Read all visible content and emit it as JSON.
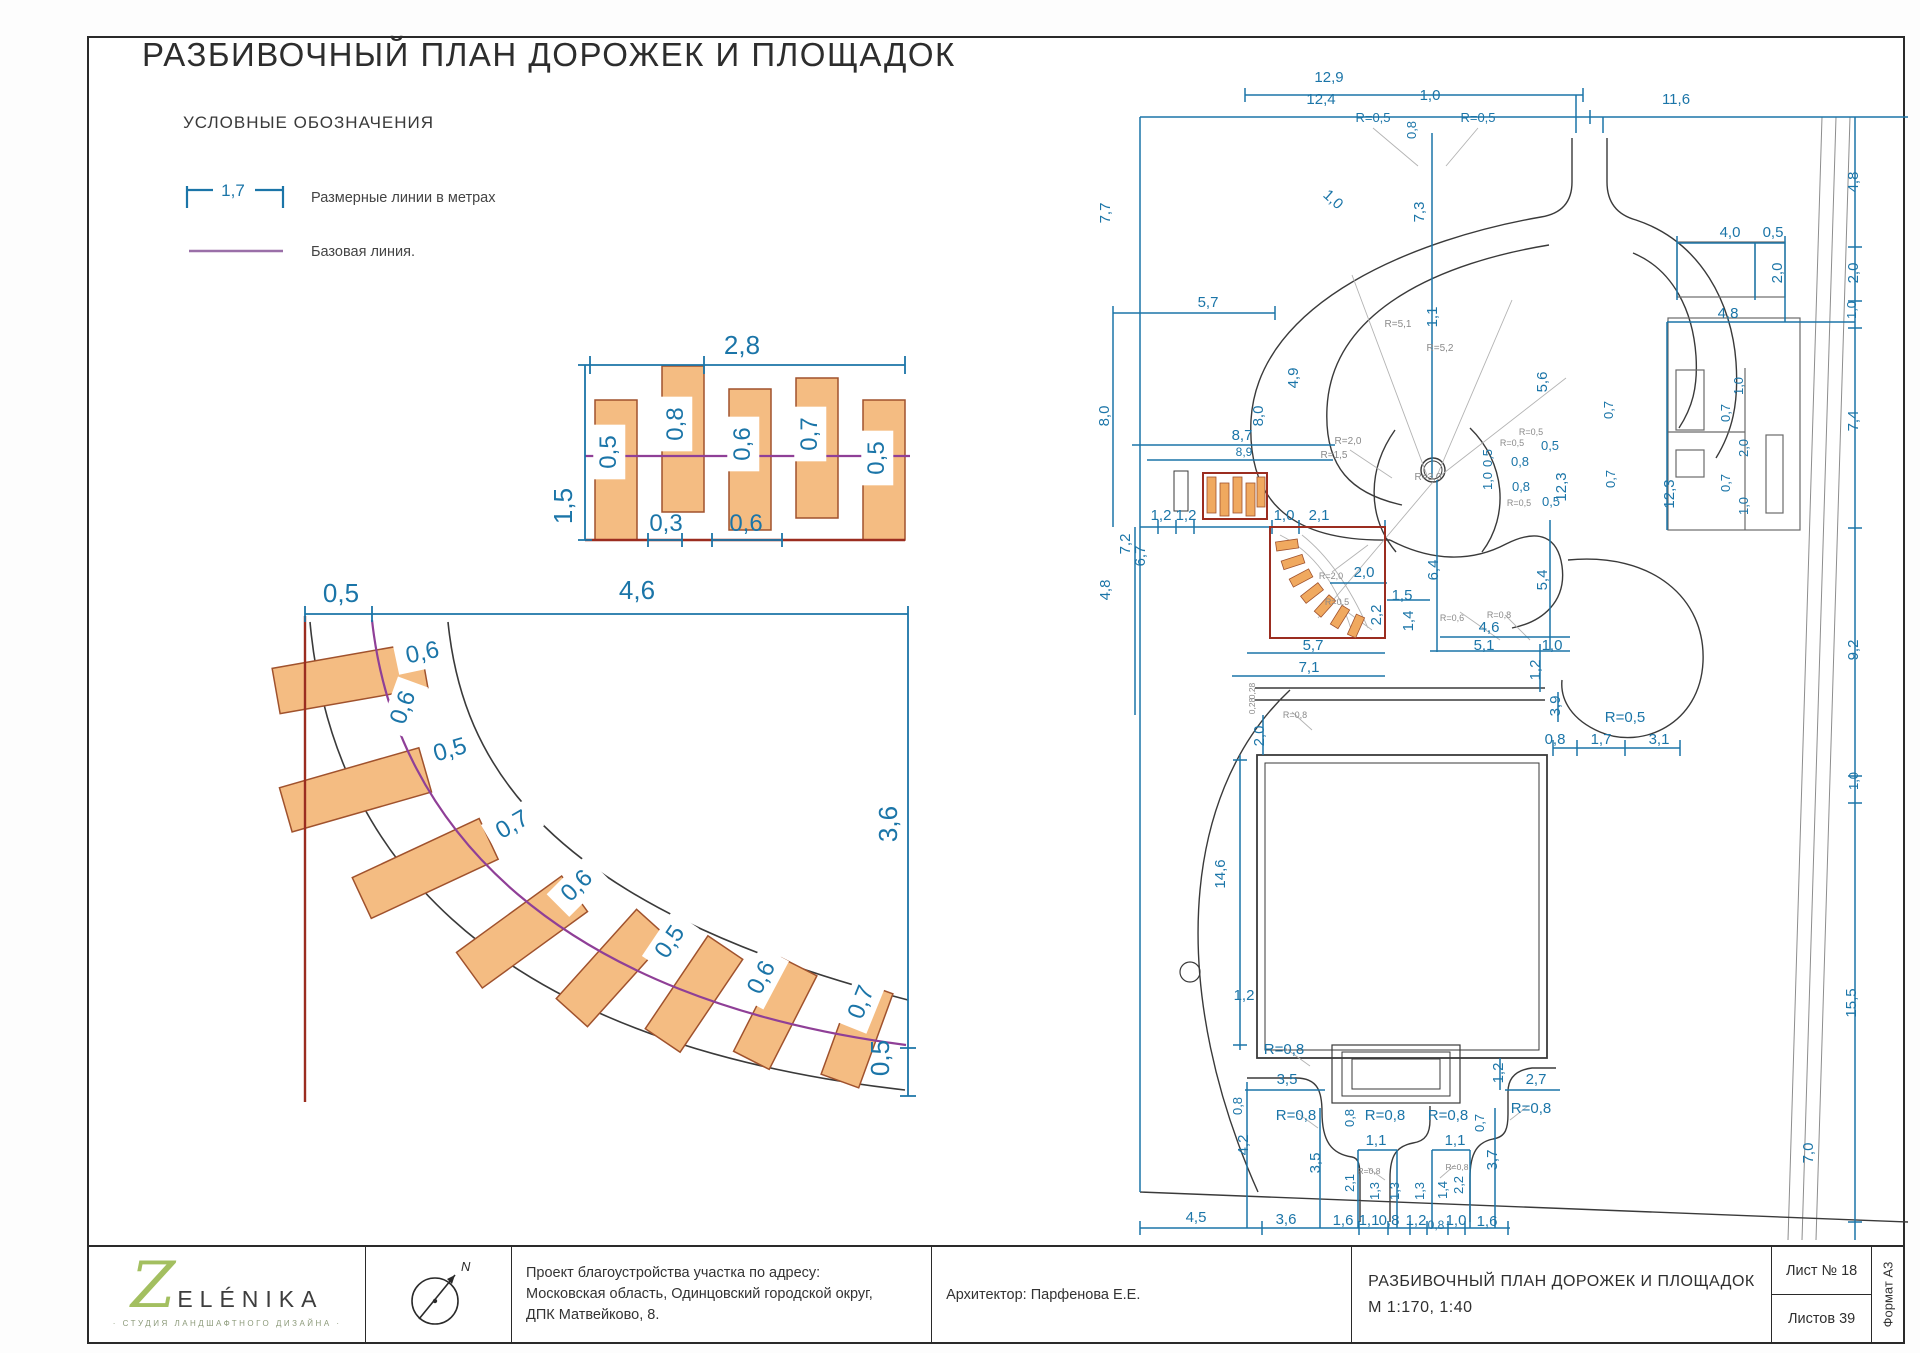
{
  "sheet": {
    "title": "РАЗБИВОЧНЫЙ ПЛАН ДОРОЖЕК И ПЛОЩАДОК"
  },
  "colors": {
    "dim": "#1b75a8",
    "geometry": "#3a3a3a",
    "red": "#9b2d20",
    "stone_fill": "#f4bc82",
    "stone_edge": "#a0522d",
    "baseline": "#8f3f97",
    "leader": "#a8a8a8"
  },
  "legend": {
    "heading": "УСЛОВНЫЕ ОБОЗНАЧЕНИЯ",
    "dim_example": "1,7",
    "dim_label": "Размерные линии в метрах",
    "base_label": "Базовая линия."
  },
  "detail_row": {
    "stones": [
      {
        "t": "0,5",
        "x": 616,
        "y": 452,
        "r": -90,
        "s": 24,
        "b": true
      },
      {
        "t": "0,8",
        "x": 683,
        "y": 424,
        "r": -90,
        "s": 24,
        "b": true
      },
      {
        "t": "0,6",
        "x": 750,
        "y": 444,
        "r": -90,
        "s": 24,
        "b": true
      },
      {
        "t": "0,7",
        "x": 817,
        "y": 434,
        "r": -90,
        "s": 24,
        "b": true
      },
      {
        "t": "0,5",
        "x": 884,
        "y": 458,
        "r": -90,
        "s": 24,
        "b": true
      }
    ],
    "labels": [
      {
        "t": "2,8",
        "x": 742,
        "y": 354,
        "s": 26
      },
      {
        "t": "1,5",
        "x": 572,
        "y": 506,
        "r": -90,
        "s": 26
      },
      {
        "t": "0,3",
        "x": 666,
        "y": 531,
        "s": 24
      },
      {
        "t": "0,6",
        "x": 746,
        "y": 531,
        "s": 24
      }
    ]
  },
  "detail_curve": {
    "stones": [
      {
        "t": "0,6",
        "x": 424,
        "y": 660,
        "r": -12,
        "s": 24,
        "b": true
      },
      {
        "t": "0,6",
        "x": 410,
        "y": 710,
        "r": -70,
        "s": 24,
        "b": true
      },
      {
        "t": "0,5",
        "x": 452,
        "y": 757,
        "r": -16,
        "s": 24,
        "b": true
      },
      {
        "t": "0,7",
        "x": 516,
        "y": 831,
        "r": -30,
        "s": 24,
        "b": true
      },
      {
        "t": "0,6",
        "x": 582,
        "y": 891,
        "r": -45,
        "s": 24,
        "b": true
      },
      {
        "t": "0,5",
        "x": 676,
        "y": 946,
        "r": -56,
        "s": 24,
        "b": true
      },
      {
        "t": "0,6",
        "x": 768,
        "y": 981,
        "r": -62,
        "s": 24,
        "b": true
      },
      {
        "t": "0,7",
        "x": 868,
        "y": 1005,
        "r": -68,
        "s": 24,
        "b": true
      }
    ],
    "labels": [
      {
        "t": "0,5",
        "x": 341,
        "y": 602,
        "s": 26
      },
      {
        "t": "4,6",
        "x": 637,
        "y": 599,
        "s": 26
      },
      {
        "t": "3,6",
        "x": 897,
        "y": 824,
        "r": -90,
        "s": 26
      },
      {
        "t": "0,5",
        "x": 889,
        "y": 1058,
        "r": -90,
        "s": 26
      }
    ]
  },
  "plan": {
    "labels": [
      {
        "t": "12,9",
        "x": 1329,
        "y": 82
      },
      {
        "t": "12,4",
        "x": 1321,
        "y": 104
      },
      {
        "t": "1,0",
        "x": 1430,
        "y": 100
      },
      {
        "t": "11,6",
        "x": 1676,
        "y": 104
      },
      {
        "t": "R=0,5",
        "x": 1373,
        "y": 122,
        "s": 13
      },
      {
        "t": "R=0,5",
        "x": 1478,
        "y": 122,
        "s": 13
      },
      {
        "t": "0,8",
        "x": 1416,
        "y": 130,
        "r": -90,
        "s": 13
      },
      {
        "t": "7,7",
        "x": 1110,
        "y": 213,
        "r": -90
      },
      {
        "t": "1,0",
        "x": 1330,
        "y": 203,
        "r": 42
      },
      {
        "t": "7,3",
        "x": 1424,
        "y": 212,
        "r": -90
      },
      {
        "t": "4,8",
        "x": 1858,
        "y": 182,
        "r": -90
      },
      {
        "t": "4,0",
        "x": 1730,
        "y": 237
      },
      {
        "t": "0,5",
        "x": 1773,
        "y": 237
      },
      {
        "t": "2,0",
        "x": 1782,
        "y": 273,
        "r": -90
      },
      {
        "t": "2,0",
        "x": 1858,
        "y": 273,
        "r": -90
      },
      {
        "t": "1,0",
        "x": 1856,
        "y": 310,
        "r": -90,
        "s": 13
      },
      {
        "t": "5,7",
        "x": 1208,
        "y": 307
      },
      {
        "t": "1,1",
        "x": 1437,
        "y": 317,
        "r": -90
      },
      {
        "t": "R=5,1",
        "x": 1398,
        "y": 327,
        "s": 10,
        "c": "#8a8a8a"
      },
      {
        "t": "R=5,2",
        "x": 1440,
        "y": 351,
        "s": 10,
        "c": "#8a8a8a"
      },
      {
        "t": "4,8",
        "x": 1728,
        "y": 318
      },
      {
        "t": "4,9",
        "x": 1298,
        "y": 378,
        "r": -90
      },
      {
        "t": "5,6",
        "x": 1547,
        "y": 382,
        "r": -90
      },
      {
        "t": "8,0",
        "x": 1263,
        "y": 416,
        "r": -90
      },
      {
        "t": "8,0",
        "x": 1109,
        "y": 416,
        "r": -90
      },
      {
        "t": "7,4",
        "x": 1858,
        "y": 421,
        "r": -90
      },
      {
        "t": "1,0",
        "x": 1743,
        "y": 386,
        "r": -90,
        "s": 13
      },
      {
        "t": "0,7",
        "x": 1730,
        "y": 413,
        "r": -90,
        "s": 13
      },
      {
        "t": "2,0",
        "x": 1748,
        "y": 448,
        "r": -90,
        "s": 13
      },
      {
        "t": "0,7",
        "x": 1730,
        "y": 483,
        "r": -90,
        "s": 13
      },
      {
        "t": "1,0",
        "x": 1748,
        "y": 506,
        "r": -90,
        "s": 13
      },
      {
        "t": "12,3",
        "x": 1674,
        "y": 494,
        "r": -90
      },
      {
        "t": "12,3",
        "x": 1566,
        "y": 487,
        "r": -90
      },
      {
        "t": "0,7",
        "x": 1613,
        "y": 410,
        "r": -90,
        "s": 13
      },
      {
        "t": "0,7",
        "x": 1615,
        "y": 479,
        "r": -90,
        "s": 13
      },
      {
        "t": "8,7",
        "x": 1242,
        "y": 440
      },
      {
        "t": "8,9",
        "x": 1244,
        "y": 456,
        "s": 12
      },
      {
        "t": "R=2,0",
        "x": 1348,
        "y": 444,
        "s": 10,
        "c": "#8a8a8a"
      },
      {
        "t": "R=1,5",
        "x": 1334,
        "y": 458,
        "s": 10,
        "c": "#8a8a8a"
      },
      {
        "t": "R=0,5",
        "x": 1531,
        "y": 435,
        "s": 9,
        "c": "#8a8a8a"
      },
      {
        "t": "R=0,5",
        "x": 1512,
        "y": 446,
        "s": 9,
        "c": "#8a8a8a"
      },
      {
        "t": "0,5",
        "x": 1550,
        "y": 450,
        "s": 13
      },
      {
        "t": "0,5",
        "x": 1492,
        "y": 458,
        "r": -90,
        "s": 13
      },
      {
        "t": "0,8",
        "x": 1520,
        "y": 466,
        "s": 13
      },
      {
        "t": "1,0",
        "x": 1492,
        "y": 481,
        "r": -90,
        "s": 13
      },
      {
        "t": "0,8",
        "x": 1521,
        "y": 491,
        "s": 13
      },
      {
        "t": "R=0,5",
        "x": 1519,
        "y": 506,
        "s": 9,
        "c": "#8a8a8a"
      },
      {
        "t": "0,5",
        "x": 1551,
        "y": 506,
        "s": 13
      },
      {
        "t": "R=3,0",
        "x": 1428,
        "y": 480,
        "s": 10,
        "c": "#8a8a8a"
      },
      {
        "t": "1,2",
        "x": 1161,
        "y": 520
      },
      {
        "t": "1,2",
        "x": 1186,
        "y": 520
      },
      {
        "t": "7,2",
        "x": 1130,
        "y": 544,
        "r": -90
      },
      {
        "t": "6,7",
        "x": 1145,
        "y": 556,
        "r": -90
      },
      {
        "t": "4,8",
        "x": 1110,
        "y": 590,
        "r": -90
      },
      {
        "t": "1,0",
        "x": 1284,
        "y": 520
      },
      {
        "t": "2,1",
        "x": 1319,
        "y": 520
      },
      {
        "t": "2,0",
        "x": 1364,
        "y": 577
      },
      {
        "t": "R=2,0",
        "x": 1331,
        "y": 579,
        "s": 9,
        "c": "#8a8a8a"
      },
      {
        "t": "R=0,5",
        "x": 1337,
        "y": 605,
        "s": 9,
        "c": "#8a8a8a"
      },
      {
        "t": "2,2",
        "x": 1381,
        "y": 615,
        "r": -90
      },
      {
        "t": "1,5",
        "x": 1402,
        "y": 600
      },
      {
        "t": "1,4",
        "x": 1413,
        "y": 621,
        "r": -90
      },
      {
        "t": "6,4",
        "x": 1438,
        "y": 570,
        "r": -90
      },
      {
        "t": "R=0,6",
        "x": 1452,
        "y": 621,
        "s": 9,
        "c": "#8a8a8a"
      },
      {
        "t": "R=0,8",
        "x": 1499,
        "y": 618,
        "s": 9,
        "c": "#8a8a8a"
      },
      {
        "t": "4,6",
        "x": 1489,
        "y": 632
      },
      {
        "t": "5,1",
        "x": 1484,
        "y": 650
      },
      {
        "t": "1,0",
        "x": 1552,
        "y": 650
      },
      {
        "t": "5,4",
        "x": 1547,
        "y": 580,
        "r": -90
      },
      {
        "t": "1,2",
        "x": 1540,
        "y": 670,
        "r": -90
      },
      {
        "t": "5,7",
        "x": 1313,
        "y": 650
      },
      {
        "t": "7,1",
        "x": 1309,
        "y": 672
      },
      {
        "t": "0,28",
        "x": 1255,
        "y": 691,
        "r": -90,
        "s": 8.5,
        "c": "#8a8a8a"
      },
      {
        "t": "0,28",
        "x": 1255,
        "y": 706,
        "r": -90,
        "s": 8.5,
        "c": "#8a8a8a"
      },
      {
        "t": "R=0,8",
        "x": 1295,
        "y": 718,
        "s": 9,
        "c": "#8a8a8a"
      },
      {
        "t": "3,9",
        "x": 1560,
        "y": 706,
        "r": -90
      },
      {
        "t": "R=0,5",
        "x": 1625,
        "y": 722
      },
      {
        "t": "0,8",
        "x": 1555,
        "y": 744
      },
      {
        "t": "1,7",
        "x": 1601,
        "y": 744
      },
      {
        "t": "3,1",
        "x": 1659,
        "y": 744
      },
      {
        "t": "9,2",
        "x": 1858,
        "y": 650,
        "r": -90
      },
      {
        "t": "1,0",
        "x": 1858,
        "y": 781,
        "r": -90,
        "s": 13
      },
      {
        "t": "2,0",
        "x": 1264,
        "y": 736,
        "r": -90
      },
      {
        "t": "14,6",
        "x": 1225,
        "y": 874,
        "r": -90
      },
      {
        "t": "1,2",
        "x": 1244,
        "y": 1000
      },
      {
        "t": "R=0,8",
        "x": 1284,
        "y": 1054
      },
      {
        "t": "15,5",
        "x": 1856,
        "y": 1003,
        "r": -90
      },
      {
        "t": "3,5",
        "x": 1287,
        "y": 1084
      },
      {
        "t": "0,8",
        "x": 1242,
        "y": 1106,
        "r": -90,
        "s": 13
      },
      {
        "t": "R=0,8",
        "x": 1296,
        "y": 1120
      },
      {
        "t": "4,2",
        "x": 1248,
        "y": 1145,
        "r": -90
      },
      {
        "t": "3,5",
        "x": 1320,
        "y": 1163,
        "r": -90
      },
      {
        "t": "0,8",
        "x": 1354,
        "y": 1118,
        "r": -90,
        "s": 13
      },
      {
        "t": "R=0,8",
        "x": 1385,
        "y": 1120
      },
      {
        "t": "R=0,8",
        "x": 1448,
        "y": 1120
      },
      {
        "t": "1,1",
        "x": 1376,
        "y": 1145
      },
      {
        "t": "1,1",
        "x": 1455,
        "y": 1145
      },
      {
        "t": "2,1",
        "x": 1354,
        "y": 1183,
        "r": -90,
        "s": 13
      },
      {
        "t": "R=0,8",
        "x": 1369,
        "y": 1174,
        "s": 8.5,
        "c": "#8a8a8a"
      },
      {
        "t": "1,3",
        "x": 1379,
        "y": 1191,
        "r": -90,
        "s": 13
      },
      {
        "t": "1,3",
        "x": 1399,
        "y": 1191,
        "r": -90,
        "s": 13
      },
      {
        "t": "1,3",
        "x": 1424,
        "y": 1191,
        "r": -90,
        "s": 13
      },
      {
        "t": "1,4",
        "x": 1447,
        "y": 1190,
        "r": -90,
        "s": 13
      },
      {
        "t": "R=0,8",
        "x": 1457,
        "y": 1170,
        "s": 8.5,
        "c": "#8a8a8a"
      },
      {
        "t": "2,2",
        "x": 1463,
        "y": 1185,
        "r": -90,
        "s": 13
      },
      {
        "t": "3,7",
        "x": 1497,
        "y": 1160,
        "r": -90
      },
      {
        "t": "1,2",
        "x": 1503,
        "y": 1073,
        "r": -90
      },
      {
        "t": "2,7",
        "x": 1536,
        "y": 1084
      },
      {
        "t": "R=0,8",
        "x": 1531,
        "y": 1113
      },
      {
        "t": "0,7",
        "x": 1484,
        "y": 1123,
        "r": -90,
        "s": 13
      },
      {
        "t": "7,0",
        "x": 1813,
        "y": 1153,
        "r": -90
      },
      {
        "t": "4,5",
        "x": 1196,
        "y": 1222
      },
      {
        "t": "3,6",
        "x": 1286,
        "y": 1224
      },
      {
        "t": "1,6",
        "x": 1343,
        "y": 1225
      },
      {
        "t": "1,1",
        "x": 1369,
        "y": 1225
      },
      {
        "t": "0,8",
        "x": 1389,
        "y": 1225
      },
      {
        "t": "1,2",
        "x": 1416,
        "y": 1225
      },
      {
        "t": "0,8",
        "x": 1436,
        "y": 1229,
        "s": 12
      },
      {
        "t": "1,0",
        "x": 1456,
        "y": 1225
      },
      {
        "t": "1,6",
        "x": 1487,
        "y": 1226
      }
    ]
  },
  "titleblock": {
    "logo_z": "Z",
    "logo_name": "ELÉNIKA",
    "logo_sub": "· СТУДИЯ ЛАНДШАФТНОГО ДИЗАЙНА ·",
    "north_label": "N",
    "project_line1": "Проект благоустройства участка по адресу:",
    "project_line2": "Московская область, Одинцовский городской округ,",
    "project_line3": "ДПК Матвейково, 8.",
    "architect": "Архитектор: Парфенова Е.Е.",
    "drawing_name": "РАЗБИВОЧНЫЙ ПЛАН ДОРОЖЕК И ПЛОЩАДОК",
    "drawing_scale": "М 1:170, 1:40",
    "sheet_no": "Лист № 18",
    "sheets_total": "Листов 39",
    "format": "Формат А3"
  }
}
